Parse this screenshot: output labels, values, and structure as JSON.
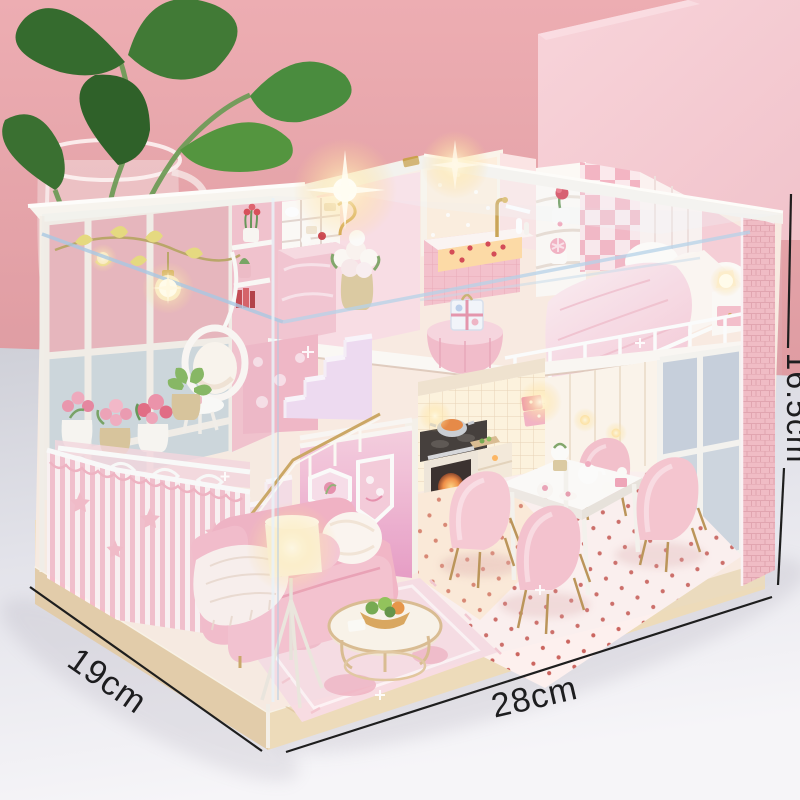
{
  "annotations": {
    "depth_label": "19cm",
    "width_label": "28cm",
    "height_label": "16.5cm"
  },
  "palette": {
    "background_pink": "#e7a4aa",
    "pedestal_pink": "#f6ccd3",
    "table_surface": "#e8e8ee",
    "house_pink": "#f6c3ce",
    "stripe_pink": "#f4bcc9",
    "warm_light": "#ffd98f",
    "wood_base": "#e8d5b5",
    "leaf_green": "#47833c",
    "annotation_line": "#1e1e1e"
  }
}
